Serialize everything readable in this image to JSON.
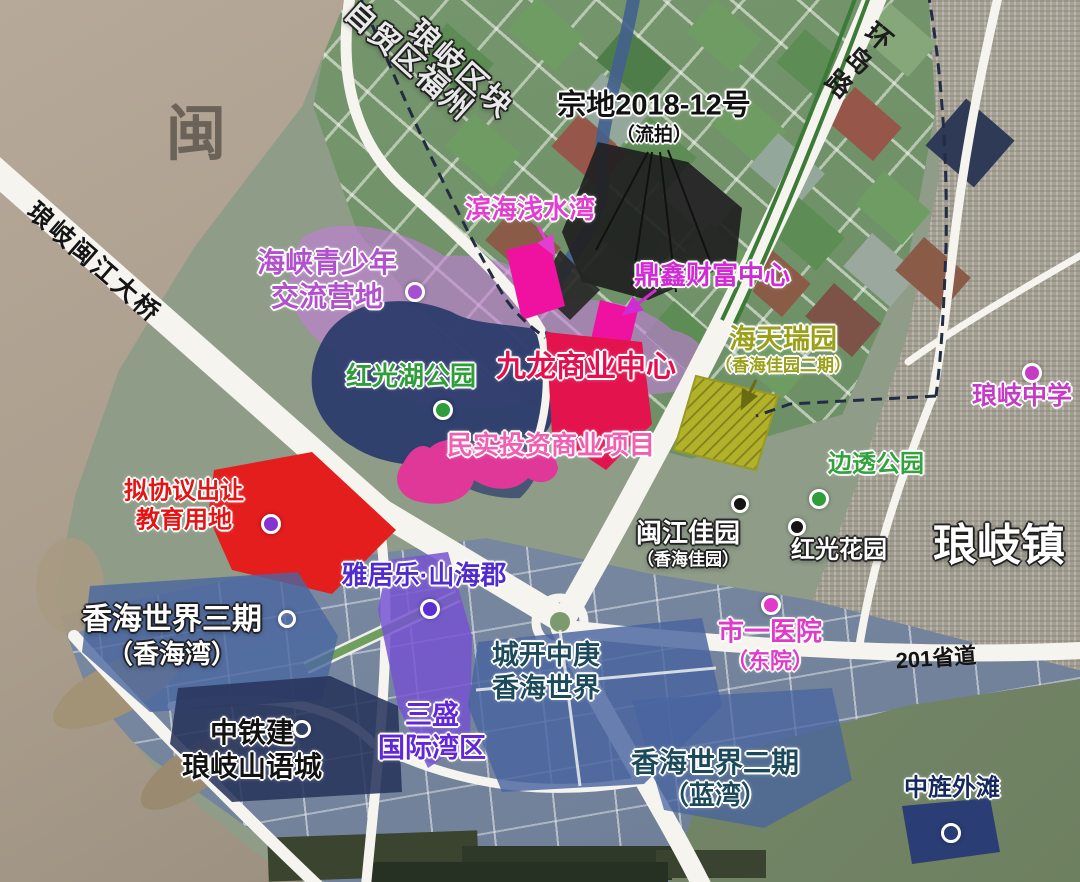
{
  "map": {
    "description": "annotated satellite land-parcel map",
    "colors": {
      "river_water": "#ab9e8d",
      "farmland": "#6e9066",
      "urban": "#a6a296",
      "development": "#7888a0",
      "hills": "#76886a",
      "road": "#f6f4ee",
      "lake": "#2c3c6c",
      "camp_purple": "#c17ed6",
      "parcel_magenta": "#ef12a0",
      "parcel_crimson": "#e3134e",
      "parcel_pink": "#e03898",
      "parcel_red": "#e41d1d",
      "parcel_olive": "#b2b22a",
      "parcel_purple": "#7656d0",
      "parcel_blue": "#47639f",
      "parcel_navy": "#2a3d74",
      "parcel_black": "#202020",
      "boundary_dash": "#222c44"
    },
    "labels": [
      {
        "name": "min-river-watermark",
        "kind": "watermark",
        "x": 196,
        "y": 134,
        "color": "#5f584d",
        "halo": "n",
        "weight": 700,
        "op": 0.85,
        "lines": [
          {
            "t": "闽",
            "s": 60
          }
        ]
      },
      {
        "name": "ftz-fuzhou-area",
        "kind": "boundary-title",
        "x": 408,
        "y": 62,
        "rotate": 42,
        "color": "#e9e9e9",
        "halo": "d",
        "weight": 700,
        "ls": 2,
        "lines": [
          {
            "t": "自贸区福州",
            "s": 30
          }
        ]
      },
      {
        "name": "langqi-block",
        "kind": "boundary-title",
        "x": 460,
        "y": 70,
        "rotate": 42,
        "color": "#e9e9e9",
        "halo": "d",
        "weight": 700,
        "ls": 2,
        "lines": [
          {
            "t": "琅岐区块",
            "s": 30
          }
        ]
      },
      {
        "name": "parcel-2018-12",
        "kind": "site",
        "x": 654,
        "y": 118,
        "color": "#111111",
        "halo": "l",
        "weight": 700,
        "lines": [
          {
            "t": "宗地2018-12号",
            "s": 29
          },
          {
            "t": "（流拍）",
            "s": 19
          }
        ]
      },
      {
        "name": "huandao-road",
        "kind": "road",
        "x": 856,
        "y": 60,
        "rotate": 40,
        "vertical": true,
        "color": "#1c1c1c",
        "halo": "n",
        "weight": 700,
        "ls": 5,
        "lines": [
          {
            "t": "环岛路",
            "s": 26
          }
        ]
      },
      {
        "name": "binhai-qianshuiwan",
        "kind": "site",
        "x": 530,
        "y": 210,
        "color": "#e23fd0",
        "halo": "l",
        "weight": 700,
        "lines": [
          {
            "t": "滨海浅水湾",
            "s": 26
          }
        ]
      },
      {
        "name": "haixia-youth-camp",
        "kind": "site",
        "x": 327,
        "y": 280,
        "color": "#b152cc",
        "halo": "l",
        "weight": 700,
        "lines": [
          {
            "t": "海峡青少年",
            "s": 28
          },
          {
            "t": "交流营地",
            "s": 28
          }
        ],
        "dot": {
          "x": 412,
          "y": 289,
          "r": 7,
          "fill": "#a64fd2"
        }
      },
      {
        "name": "dingxin-wealth-center",
        "kind": "site",
        "x": 712,
        "y": 276,
        "color": "#cf2cd4",
        "halo": "l",
        "weight": 700,
        "lines": [
          {
            "t": "鼎鑫财富中心",
            "s": 26
          }
        ]
      },
      {
        "name": "haitian-ruiyuan",
        "kind": "site",
        "x": 783,
        "y": 350,
        "color": "#9aa018",
        "halo": "l",
        "weight": 700,
        "lines": [
          {
            "t": "海天瑞园",
            "s": 27
          },
          {
            "t": "（香海佳园二期）",
            "s": 17
          }
        ]
      },
      {
        "name": "hongguang-lake-park",
        "kind": "site",
        "x": 411,
        "y": 377,
        "color": "#2f9e3a",
        "halo": "l",
        "weight": 700,
        "lines": [
          {
            "t": "红光湖公园",
            "s": 26
          }
        ],
        "dot": {
          "x": 440,
          "y": 407,
          "r": 7,
          "fill": "#2f9e3a"
        }
      },
      {
        "name": "jiulong-business-center",
        "kind": "site",
        "x": 586,
        "y": 368,
        "color": "#e60f4e",
        "halo": "l",
        "weight": 800,
        "lines": [
          {
            "t": "九龙商业中心",
            "s": 30
          }
        ]
      },
      {
        "name": "langqi-middle-school",
        "kind": "site",
        "x": 1022,
        "y": 396,
        "color": "#c43cc4",
        "halo": "l",
        "weight": 700,
        "lines": [
          {
            "t": "琅岐中学",
            "s": 25
          }
        ],
        "dot": {
          "x": 1029,
          "y": 370,
          "r": 7,
          "fill": "#c43cc4"
        }
      },
      {
        "name": "minshi-commercial",
        "kind": "site",
        "x": 551,
        "y": 446,
        "color": "#f060b2",
        "halo": "l",
        "weight": 700,
        "lines": [
          {
            "t": "民实投资商业项目",
            "s": 26
          }
        ]
      },
      {
        "name": "biantou-park",
        "kind": "site",
        "x": 876,
        "y": 464,
        "color": "#33a23e",
        "halo": "l",
        "weight": 700,
        "lines": [
          {
            "t": "边透公园",
            "s": 24
          }
        ],
        "dot": {
          "x": 816,
          "y": 496,
          "r": 7,
          "fill": "#2f9e3a"
        }
      },
      {
        "name": "education-land",
        "kind": "site",
        "x": 184,
        "y": 506,
        "color": "#e51414",
        "halo": "l",
        "weight": 700,
        "lines": [
          {
            "t": "拟协议出让",
            "s": 24
          },
          {
            "t": "教育用地",
            "s": 24
          }
        ],
        "dot": {
          "x": 268,
          "y": 521,
          "r": 7,
          "fill": "#8633d6"
        }
      },
      {
        "name": "minjiang-jiayuan",
        "kind": "site",
        "x": 688,
        "y": 544,
        "color": "#ffffff",
        "halo": "d",
        "weight": 700,
        "lines": [
          {
            "t": "闽江佳园",
            "s": 26
          },
          {
            "t": "（香海佳园）",
            "s": 17
          }
        ],
        "dot": {
          "x": 737,
          "y": 501,
          "r": 6,
          "fill": "#141414"
        }
      },
      {
        "name": "hongguang-garden",
        "kind": "site",
        "x": 839,
        "y": 550,
        "color": "#ffffff",
        "halo": "d",
        "weight": 700,
        "lines": [
          {
            "t": "红光花园",
            "s": 24
          }
        ],
        "dot": {
          "x": 794,
          "y": 524,
          "r": 6,
          "fill": "#141414"
        }
      },
      {
        "name": "langqi-town",
        "kind": "town",
        "x": 999,
        "y": 546,
        "color": "#ffffff",
        "halo": "d",
        "weight": 800,
        "lines": [
          {
            "t": "琅岐镇",
            "s": 44
          }
        ]
      },
      {
        "name": "yajule-shanhaijun",
        "kind": "site",
        "x": 424,
        "y": 576,
        "color": "#4f2bd0",
        "halo": "l",
        "weight": 800,
        "lines": [
          {
            "t": "雅居乐·山海郡",
            "s": 26
          }
        ],
        "dot": {
          "x": 427,
          "y": 606,
          "r": 7,
          "fill": "#5a2fd0"
        }
      },
      {
        "name": "xianghai-world-3",
        "kind": "site",
        "x": 172,
        "y": 636,
        "color": "#ffffff",
        "halo": "d",
        "weight": 800,
        "lines": [
          {
            "t": "香海世界三期",
            "s": 30
          },
          {
            "t": "（香海湾）",
            "s": 26
          }
        ],
        "dot": {
          "x": 284,
          "y": 616,
          "r": 6,
          "ringOnly": true
        }
      },
      {
        "name": "shiyi-hospital",
        "kind": "site",
        "x": 770,
        "y": 646,
        "color": "#df3bc9",
        "halo": "l",
        "weight": 700,
        "lines": [
          {
            "t": "市一医院",
            "s": 26
          },
          {
            "t": "（东院）",
            "s": 22
          }
        ],
        "dot": {
          "x": 768,
          "y": 602,
          "r": 7,
          "fill": "#df3bc9"
        }
      },
      {
        "name": "s201",
        "kind": "road",
        "x": 936,
        "y": 659,
        "rotate": -4,
        "color": "#141414",
        "halo": "n",
        "weight": 700,
        "lines": [
          {
            "t": "201省道",
            "s": 22
          }
        ]
      },
      {
        "name": "chengkai-zhonggeng",
        "kind": "site",
        "x": 546,
        "y": 672,
        "color": "#1c4a5c",
        "halo": "l",
        "weight": 800,
        "lines": [
          {
            "t": "城开中庚",
            "s": 27
          },
          {
            "t": "香海世界",
            "s": 27
          }
        ]
      },
      {
        "name": "sansheng-intl-bay",
        "kind": "site",
        "x": 432,
        "y": 732,
        "color": "#6227d8",
        "halo": "l",
        "weight": 800,
        "lines": [
          {
            "t": "三盛",
            "s": 27
          },
          {
            "t": "国际湾区",
            "s": 27
          }
        ]
      },
      {
        "name": "ztj-langqi-shanyucheng",
        "kind": "site",
        "x": 252,
        "y": 750,
        "color": "#121212",
        "halo": "l",
        "weight": 800,
        "lines": [
          {
            "t": "中铁建",
            "s": 28
          },
          {
            "t": "琅岐山语城",
            "s": 28
          }
        ],
        "dot": {
          "x": 299,
          "y": 726,
          "r": 6,
          "ringOnly": true
        }
      },
      {
        "name": "xianghai-world-2",
        "kind": "site",
        "x": 715,
        "y": 779,
        "color": "#1c4a5c",
        "halo": "l",
        "weight": 800,
        "lines": [
          {
            "t": "香海世界二期",
            "s": 28
          },
          {
            "t": "（蓝湾）",
            "s": 26
          }
        ]
      },
      {
        "name": "zhongjing-waitan",
        "kind": "site",
        "x": 952,
        "y": 788,
        "color": "#16295e",
        "halo": "l",
        "weight": 800,
        "lines": [
          {
            "t": "中旌外滩",
            "s": 24
          }
        ],
        "dot": {
          "x": 948,
          "y": 830,
          "r": 7,
          "ringOnly": true
        }
      },
      {
        "name": "langqi-minjiang-bridge",
        "kind": "road",
        "x": 94,
        "y": 263,
        "rotate": 41,
        "color": "#141414",
        "halo": "n",
        "weight": 700,
        "ls": 3,
        "lines": [
          {
            "t": "琅岐闽江大桥",
            "s": 25
          }
        ]
      }
    ]
  }
}
